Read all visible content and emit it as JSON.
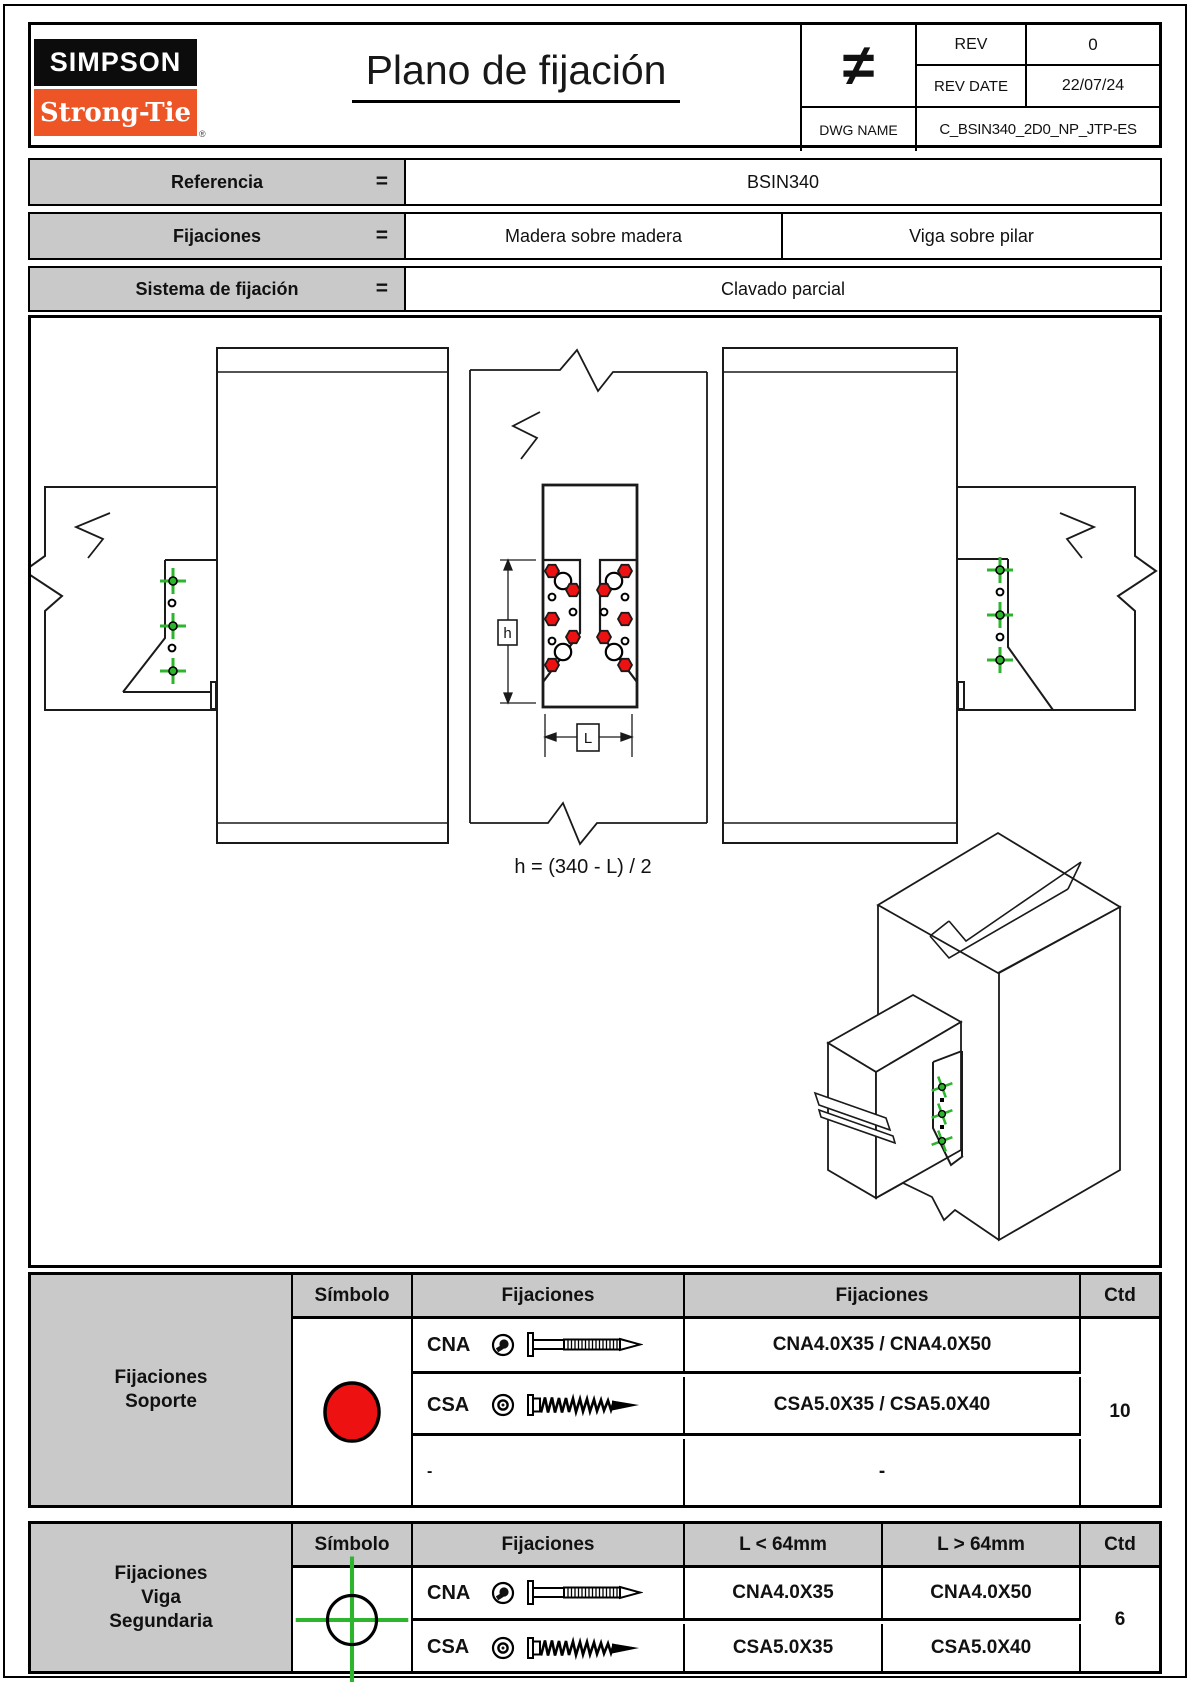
{
  "header": {
    "logo_line1": "SIMPSON",
    "logo_line2": "Strong-Tie",
    "registered": "®",
    "title": "Plano de fijación",
    "neq": "≠",
    "rev_label": "REV",
    "rev_value": "0",
    "rev_date_label": "REV DATE",
    "rev_date_value": "22/07/24",
    "dwg_label": "DWG NAME",
    "dwg_value": "C_BSIN340_2D0_NP_JTP-ES"
  },
  "info_rows": [
    {
      "label": "Referencia",
      "eq": "=",
      "values": [
        "BSIN340"
      ]
    },
    {
      "label": "Fijaciones",
      "eq": "=",
      "values": [
        "Madera sobre madera",
        "Viga sobre pilar"
      ]
    },
    {
      "label": "Sistema de fijación",
      "eq": "=",
      "values": [
        "Clavado parcial"
      ]
    }
  ],
  "drawing": {
    "formula": "h = (340 - L) / 2",
    "dim_h_label": "h",
    "dim_l_label": "L"
  },
  "support_table": {
    "label_lines": [
      "Fijaciones",
      "Soporte"
    ],
    "col_symbol": "Símbolo",
    "col_fixings_icons": "Fijaciones",
    "col_fixings_names": "Fijaciones",
    "col_qty": "Ctd",
    "rows": [
      {
        "code": "CNA",
        "value": "CNA4.0X35 / CNA4.0X50"
      },
      {
        "code": "CSA",
        "value": "CSA5.0X35 / CSA5.0X40"
      },
      {
        "code": "-",
        "value": "-"
      }
    ],
    "qty": "10"
  },
  "secondary_table": {
    "label_lines": [
      "Fijaciones",
      "Viga",
      "Segundaria"
    ],
    "col_symbol": "Símbolo",
    "col_fixings": "Fijaciones",
    "col_lt": "L < 64mm",
    "col_gt": "L > 64mm",
    "col_qty": "Ctd",
    "rows": [
      {
        "code": "CNA",
        "lt": "CNA4.0X35",
        "gt": "CNA4.0X50"
      },
      {
        "code": "CSA",
        "lt": "CSA5.0X35",
        "gt": "CSA5.0X40"
      }
    ],
    "qty": "6"
  },
  "colors": {
    "accent_red": "#ee1111",
    "accent_green": "#2db52d",
    "brand_orange": "#ee5526",
    "header_gray": "#c9c9c9"
  }
}
